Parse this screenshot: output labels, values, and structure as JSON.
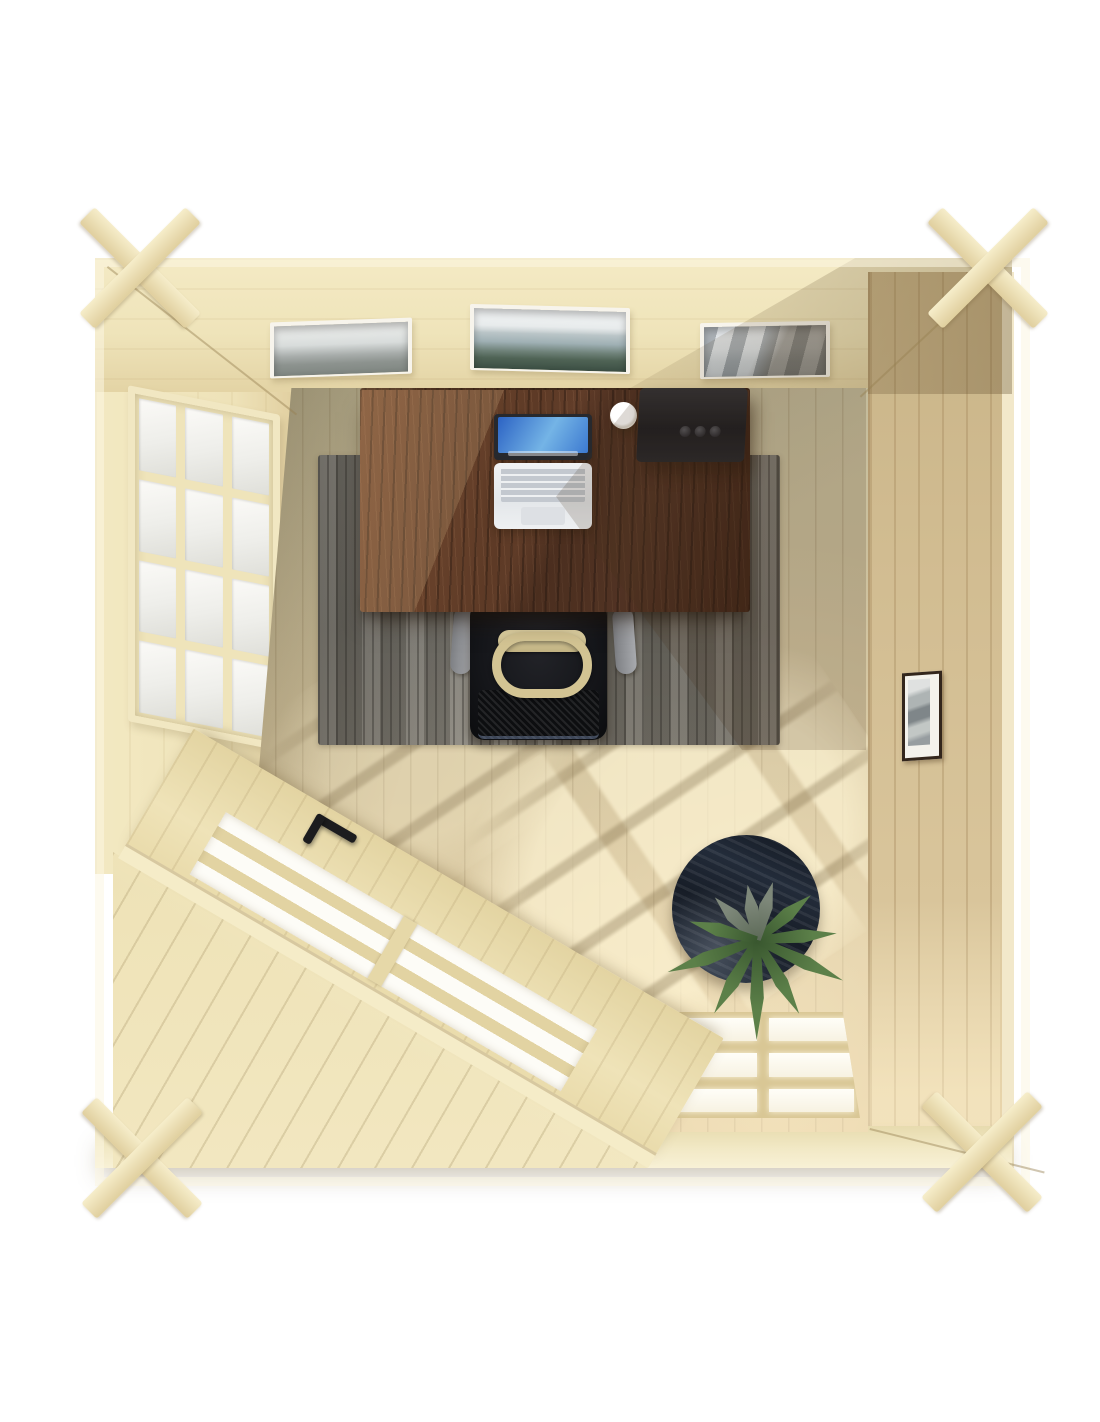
{
  "scene": {
    "type": "3d-product-render",
    "view": "top-down-interior",
    "subject": "square wooden log cabin garden office, bird's-eye view",
    "background": "#ffffff"
  },
  "room": {
    "top_wall": {
      "feature": "three clerestory windows",
      "views": [
        "hazy mountain",
        "coastal clouds over dark shore",
        "snowy mountain peaks"
      ]
    },
    "left_wall": {
      "feature": "twelve-pane casement window",
      "panes": 12
    },
    "right_wall": {
      "feature": "small framed black-and-white photo"
    },
    "bottom_wall": {
      "feature": "nine-pane window glowing with daylight",
      "panes": 9
    },
    "corner_entrance": {
      "position": "bottom-left",
      "feature": "diagonal glazed door with three glass slats and black handle"
    },
    "floor": "pale pine planks with sunlight grid shadows",
    "corners": "cross-lap log joints protruding at all four corners"
  },
  "objects": {
    "desk": {
      "label": "dark walnut desk",
      "items": [
        "open laptop with blue wallpaper",
        "white mug",
        "black speaker box with three buttons"
      ]
    },
    "chair": {
      "label": "black office chair with gray armrests"
    },
    "bag": {
      "label": "tan backpack hung on chair"
    },
    "rug": {
      "label": "gray striped area rug"
    },
    "plant": {
      "label": "green succulent plant on round navy side table"
    },
    "picture": {
      "label": "framed monochrome photo on right wall"
    }
  },
  "palette": {
    "background": "#ffffff",
    "wood_pale": "#efe4bc",
    "wood_pale_hi": "#f7efd2",
    "wood_pale_lo": "#ddcb9b",
    "wood_grain": "#c9b586",
    "wall_tan": "#d4c096",
    "wall_tan_line": "#b49a6e",
    "floor_base": "#cec5a4",
    "floor_warm": "#e3cfa4",
    "floor_bright": "#f6ead0",
    "deck_pale": "#f0e5bd",
    "desk_dark": "#4a2c1c",
    "desk_mid": "#6b4229",
    "desk_hi": "#8a5a3a",
    "rug_base": "#8f8c88",
    "rug_dark": "#63605d",
    "rug_light": "#b7b3ae",
    "chair_black": "#15161a",
    "chair_gray": "#94969a",
    "bag_tan": "#d3c493",
    "laptop_body": "#e9ecef",
    "laptop_key": "#c3c8cf",
    "screen_blue_a": "#2c63c4",
    "screen_blue_b": "#74b4e6",
    "speaker_black": "#222226",
    "mug_white": "#f4f1e9",
    "pot_navy": "#1d2530",
    "pot_navy_hi": "#39465a",
    "leaf_green": "#5c8049",
    "leaf_green_dark": "#39572f",
    "leaf_gray": "#7e887a",
    "glass_white": "#fdfcf7",
    "muntin_cream": "#e9ddb0",
    "frame_dark": "#33261c",
    "photo_gray": "#a7abad",
    "shadow_warm": "rgba(92,72,40,0.28)",
    "sun_light": "rgba(255,246,214,0.65)"
  }
}
